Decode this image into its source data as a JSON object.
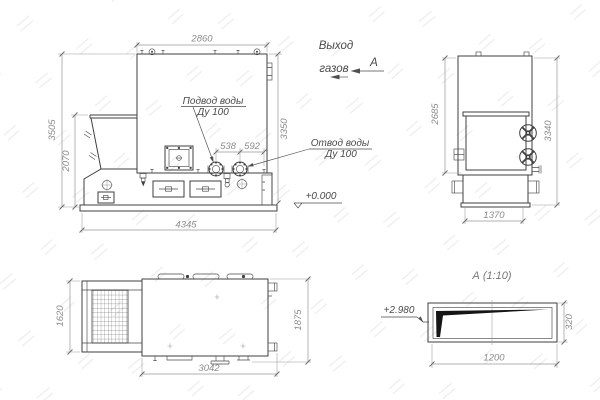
{
  "front_view": {
    "dim_width_top": "2860",
    "dim_height_total": "3505",
    "dim_height_hopper": "2070",
    "dim_length_base": "4345",
    "dim_height_body": "3350",
    "dim_flange_left": "538",
    "dim_flange_right": "592",
    "label_supply_line1": "Подвод воды",
    "label_supply_line2": "Ду 100",
    "label_return_line1": "Отвод воды",
    "label_return_line2": "Ду 100",
    "elevation_zero": "+0.000"
  },
  "side_view": {
    "dim_height_body": "2685",
    "dim_height_total": "3340",
    "dim_width_base": "1370"
  },
  "plan_view": {
    "dim_width_hopper": "1620",
    "dim_length": "3042",
    "dim_width_total": "1875"
  },
  "section_view": {
    "title": "А (1:10)",
    "dim_length": "1200",
    "dim_height": "320",
    "elevation": "+2.980"
  },
  "annotations": {
    "gas_outlet_line1": "Выход",
    "gas_outlet_line2": "газов",
    "section_mark": "А"
  },
  "colors": {
    "outline": "#3f3f3f",
    "dim_line": "#979797",
    "dim_text": "#8c8c8c",
    "annotation_text": "#4a4a4a",
    "section_fill": "#151515",
    "background": "#ffffff"
  }
}
